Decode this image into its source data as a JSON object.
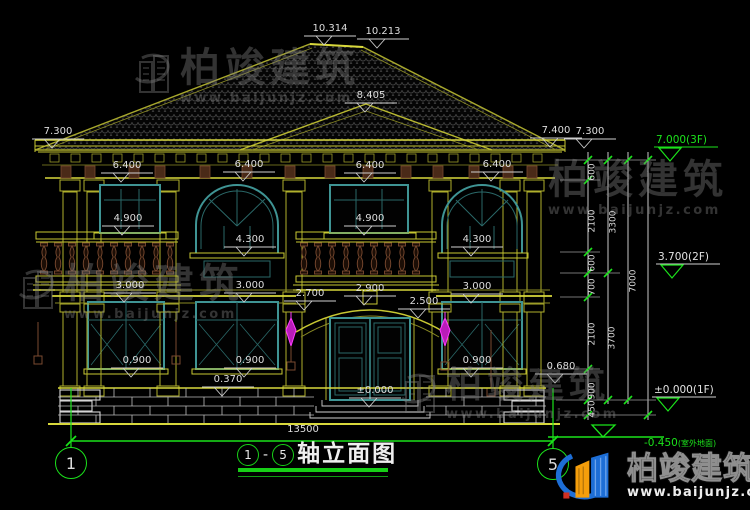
{
  "drawing_title": {
    "axis_start": "1",
    "separator": "-",
    "axis_end": "5",
    "name": "轴立面图"
  },
  "brand": {
    "name": "柏竣建筑",
    "url": "www.baijunjz.com"
  },
  "colors": {
    "cad_yellow": "#c8c832",
    "cad_teal": "#3f9494",
    "cad_green": "#1be31b",
    "dim_white": "#dedede",
    "lamp_magenta": "#d828d8",
    "logo_blue": "#1d6ed6",
    "logo_orange": "#f59e0b"
  },
  "axis_bubbles": [
    {
      "label": "1",
      "x": 71,
      "y": 463
    },
    {
      "label": "5",
      "x": 553,
      "y": 464
    }
  ],
  "annotations": {
    "dims": [
      {
        "t": "10.314",
        "x": 330,
        "y": 29
      },
      {
        "t": "10.213",
        "x": 383,
        "y": 32
      },
      {
        "t": "8.405",
        "x": 371,
        "y": 96
      },
      {
        "t": "7.300",
        "x": 58,
        "y": 132
      },
      {
        "t": "7.400",
        "x": 556,
        "y": 131
      },
      {
        "t": "7.300",
        "x": 590,
        "y": 132
      },
      {
        "t": "6.400",
        "x": 127,
        "y": 166
      },
      {
        "t": "6.400",
        "x": 249,
        "y": 165
      },
      {
        "t": "6.400",
        "x": 370,
        "y": 166
      },
      {
        "t": "6.400",
        "x": 497,
        "y": 165
      },
      {
        "t": "4.900",
        "x": 128,
        "y": 219
      },
      {
        "t": "4.900",
        "x": 370,
        "y": 219
      },
      {
        "t": "4.300",
        "x": 250,
        "y": 240
      },
      {
        "t": "4.300",
        "x": 477,
        "y": 240
      },
      {
        "t": "3.000",
        "x": 130,
        "y": 286
      },
      {
        "t": "3.000",
        "x": 250,
        "y": 286
      },
      {
        "t": "3.000",
        "x": 477,
        "y": 287
      },
      {
        "t": "2.700",
        "x": 310,
        "y": 294
      },
      {
        "t": "2.900",
        "x": 370,
        "y": 289
      },
      {
        "t": "2.500",
        "x": 424,
        "y": 302
      },
      {
        "t": "0.900",
        "x": 137,
        "y": 361
      },
      {
        "t": "0.900",
        "x": 250,
        "y": 361
      },
      {
        "t": "0.900",
        "x": 477,
        "y": 361
      },
      {
        "t": "0.370",
        "x": 228,
        "y": 380
      },
      {
        "t": "0.680",
        "x": 561,
        "y": 367
      },
      {
        "t": "±0.000",
        "x": 375,
        "y": 391
      }
    ],
    "chains": [
      {
        "t": "600",
        "x": 593,
        "y": 172
      },
      {
        "t": "2100",
        "x": 593,
        "y": 221
      },
      {
        "t": "3300",
        "x": 614,
        "y": 222
      },
      {
        "t": "600",
        "x": 593,
        "y": 263
      },
      {
        "t": "700",
        "x": 593,
        "y": 287
      },
      {
        "t": "2100",
        "x": 593,
        "y": 334
      },
      {
        "t": "900",
        "x": 593,
        "y": 391
      },
      {
        "t": "450",
        "x": 593,
        "y": 409
      },
      {
        "t": "3700",
        "x": 613,
        "y": 338
      },
      {
        "t": "7000",
        "x": 634,
        "y": 281
      }
    ],
    "levels": [
      {
        "t": "7.000(3F)",
        "x": 656,
        "y": 140,
        "green": true
      },
      {
        "t": "3.700(2F)",
        "x": 658,
        "y": 257,
        "green": false
      },
      {
        "t": "±0.000(1F)",
        "x": 654,
        "y": 390,
        "green": false
      },
      {
        "t": "-0.450",
        "suffix": "(室外地面)",
        "x": 644,
        "y": 443,
        "green": true,
        "nomark": true
      }
    ],
    "overall": {
      "t": "13500",
      "x": 303,
      "y": 430
    }
  },
  "watermark_instances": [
    {
      "x": 128,
      "y": 48,
      "icon": true,
      "fs": 40
    },
    {
      "x": 548,
      "y": 160,
      "icon": false,
      "fs": 40
    },
    {
      "x": 12,
      "y": 264,
      "icon": true,
      "fs": 40
    },
    {
      "x": 394,
      "y": 368,
      "icon": true,
      "fs": 36
    }
  ]
}
